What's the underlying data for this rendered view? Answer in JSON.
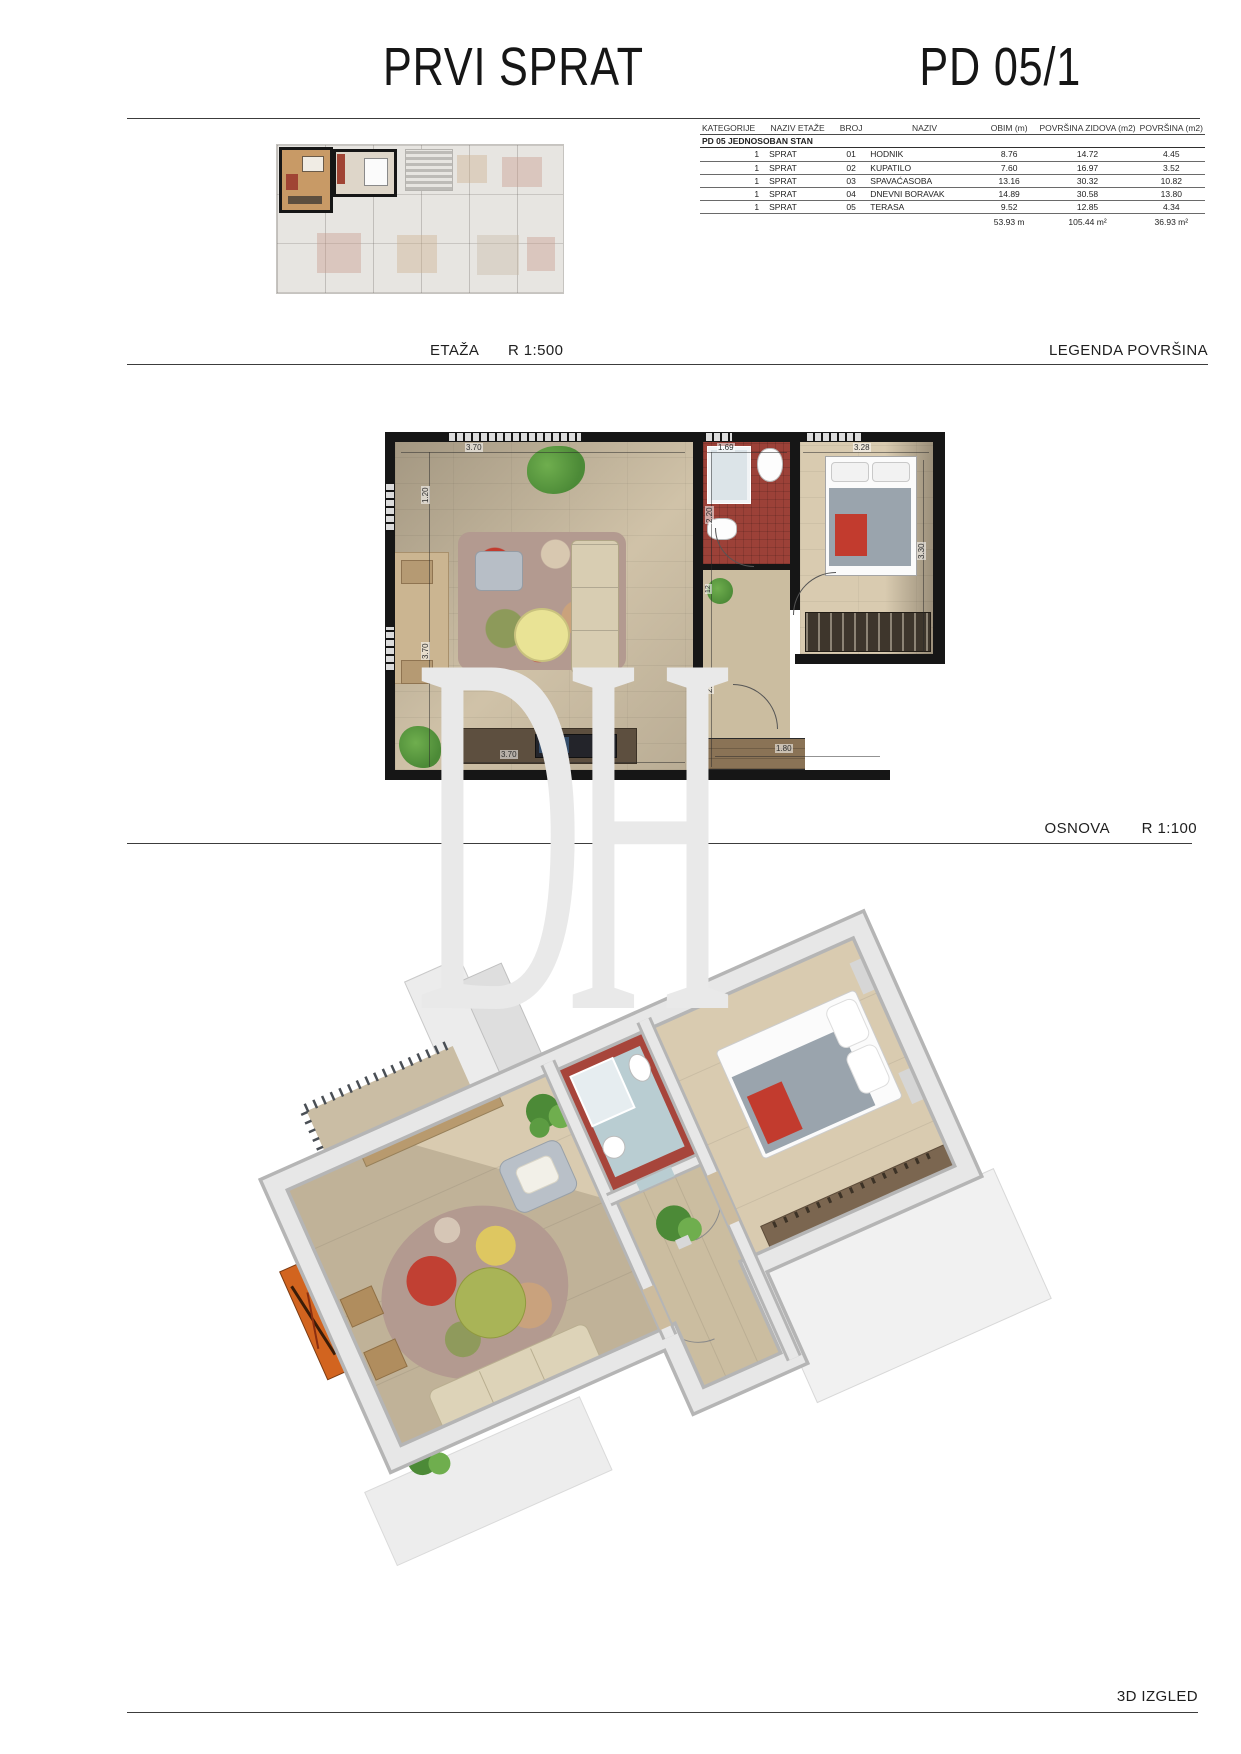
{
  "page": {
    "title": "PRVI SPRAT",
    "code": "PD 05/1"
  },
  "sections": {
    "etaza": {
      "label": "ETAŽA",
      "scale": "R 1:500",
      "legend": "LEGENDA POVRŠINA"
    },
    "osnova": {
      "label": "OSNOVA",
      "scale": "R 1:100"
    },
    "izgled": {
      "label": "3D IZGLED"
    }
  },
  "table": {
    "headers": [
      "KATEGORIJE",
      "NAZIV ETAŽE",
      "BROJ",
      "NAZIV",
      "OBIM (m)",
      "POVRŠINA ZIDOVA (m2)",
      "POVRŠINA (m2)"
    ],
    "group": "PD 05 JEDNOSOBAN STAN",
    "rows": [
      [
        "1",
        "SPRAT",
        "01",
        "HODNIK",
        "8.76",
        "14.72",
        "4.45"
      ],
      [
        "1",
        "SPRAT",
        "02",
        "KUPATILO",
        "7.60",
        "16.97",
        "3.52"
      ],
      [
        "1",
        "SPRAT",
        "03",
        "SPAVAĆASOBA",
        "13.16",
        "30.32",
        "10.82"
      ],
      [
        "1",
        "SPRAT",
        "04",
        "DNEVNI BORAVAK",
        "14.89",
        "30.58",
        "13.80"
      ],
      [
        "1",
        "SPRAT",
        "05",
        "TERASA",
        "9.52",
        "12.85",
        "4.34"
      ]
    ],
    "totals": [
      "53.93 m",
      "105.44 m²",
      "36.93 m²"
    ]
  },
  "plan": {
    "dims": [
      "3.70",
      "1.69",
      "3.28",
      "1.20",
      "3.70",
      "2.20",
      "12",
      "2.78",
      "3.30",
      "3.70",
      "1.80"
    ]
  },
  "watermark": "DH",
  "colors": {
    "wall": "#161616",
    "wood-light": "#d9cbb0",
    "wood-mid": "#cbbda0",
    "wood-dark": "#5d4f3f",
    "red-tile": "#9c4138",
    "accent-red": "#c23b2e",
    "rug-base": "#b39a90",
    "table-yellow": "#e9e395",
    "green-table": "#a9b457",
    "plant-green": "#4c8a37",
    "tv-blue": "#3c5f86",
    "painting-orange": "#d2641f",
    "bath-floor": "#b9cdd2",
    "blanket-gray": "#9aa4ad",
    "watermark": "#e9e9e9"
  }
}
